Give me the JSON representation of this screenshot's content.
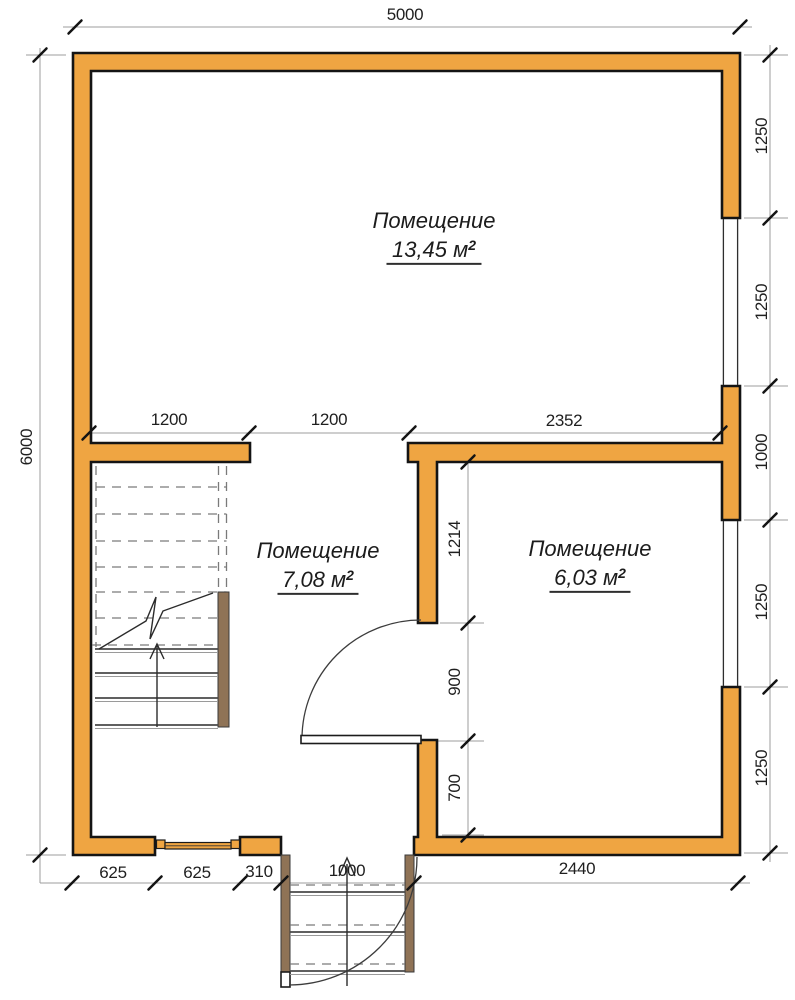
{
  "colors": {
    "wall_fill": "#EFA542",
    "wood": "#8F7356",
    "dim_line": "#9C9C9C",
    "outline": "#141414",
    "text": "#1F1F1F"
  },
  "rooms": [
    {
      "name": "Помещение",
      "area": "13,45 м",
      "sup": "2"
    },
    {
      "name": "Помещение",
      "area": "7,08 м",
      "sup": "2"
    },
    {
      "name": "Помещение",
      "area": "6,03 м",
      "sup": "2"
    }
  ],
  "dimensions": {
    "top": "5000",
    "left": "6000",
    "right": [
      "1250",
      "1250",
      "1000",
      "1250",
      "1250"
    ],
    "interior_top": [
      "1200",
      "1200",
      "2352"
    ],
    "interior_vertical": [
      "1214",
      "900",
      "700"
    ],
    "bottom": [
      "625",
      "625",
      "310",
      "1000",
      "2440"
    ]
  }
}
